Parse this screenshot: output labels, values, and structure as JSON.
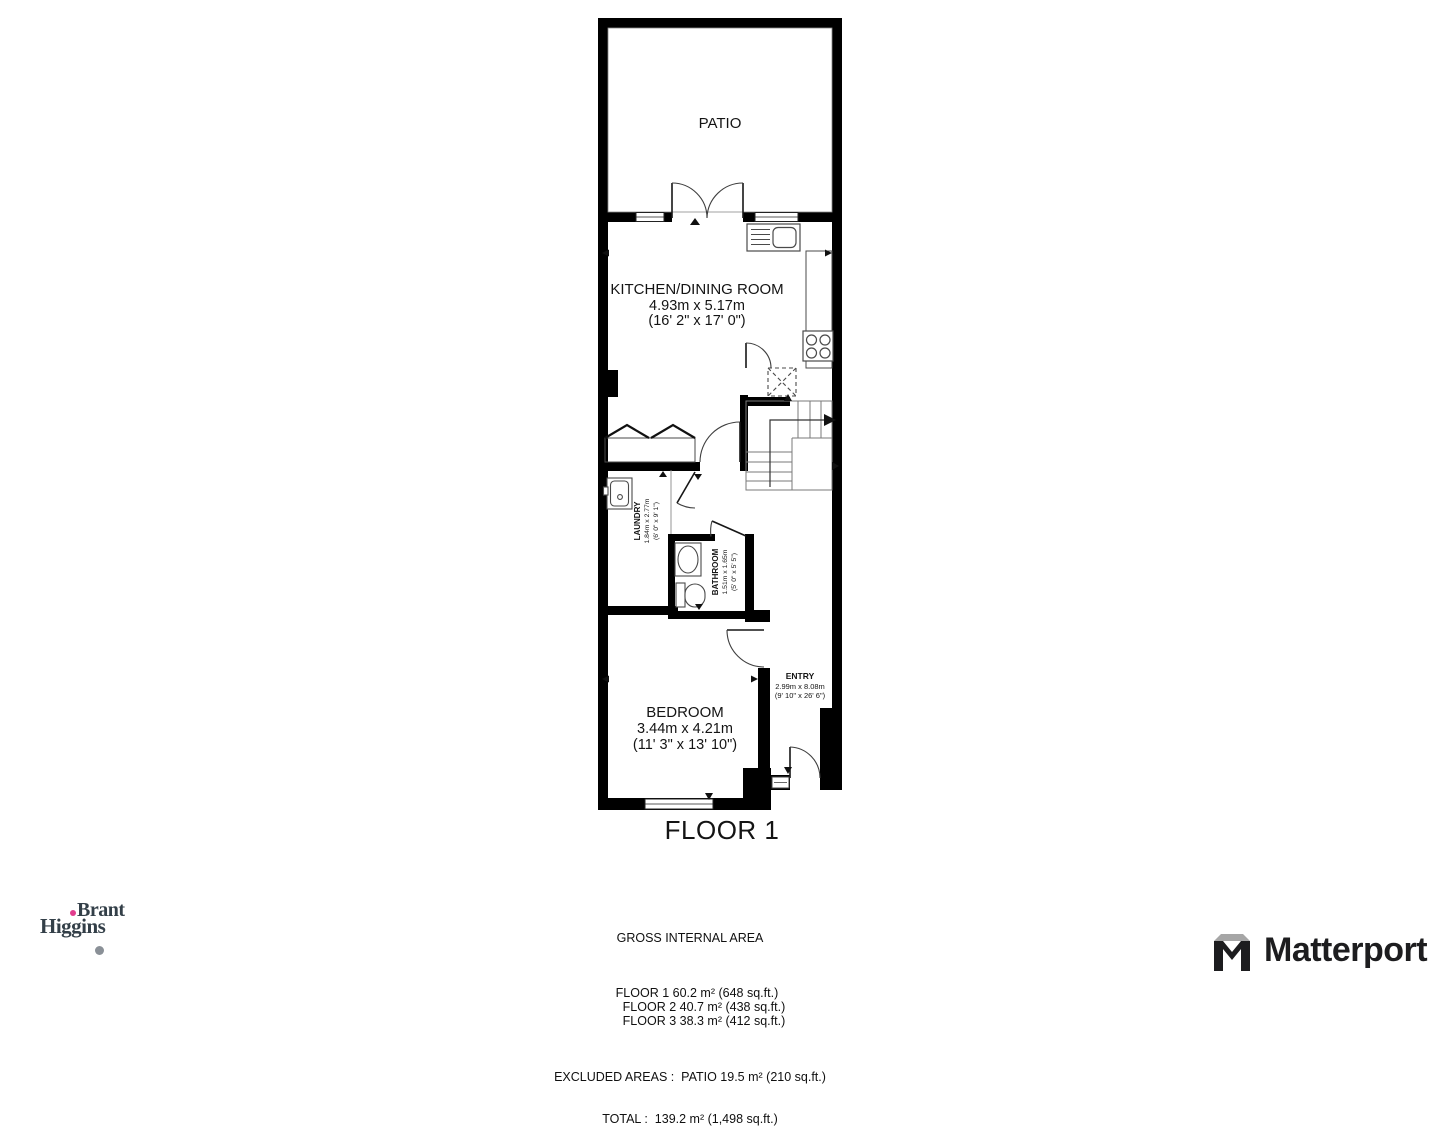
{
  "floor_label": "FLOOR 1",
  "rooms": {
    "patio": {
      "name": "PATIO"
    },
    "kitchen_dining": {
      "name": "KITCHEN/DINING ROOM",
      "size_metric": "4.93m x 5.17m",
      "size_imperial": "(16' 2\" x 17' 0\")"
    },
    "laundry": {
      "name": "LAUNDRY",
      "size_metric": "1.84m x 2.77m",
      "size_imperial": "(6' 0\" x 9' 1\")"
    },
    "bathroom": {
      "name": "BATHROOM",
      "size_metric": "1.51m x 1.65m",
      "size_imperial": "(5' 0\" x 5' 5\")"
    },
    "bedroom": {
      "name": "BEDROOM",
      "size_metric": "3.44m x 4.21m",
      "size_imperial": "(11' 3\" x 13' 10\")"
    },
    "entry": {
      "name": "ENTRY",
      "size_metric": "2.99m x 8.08m",
      "size_imperial": "(9' 10\" x 26' 6\")"
    }
  },
  "summary": {
    "heading": "GROSS INTERNAL AREA",
    "floors": [
      "FLOOR 1 60.2 m² (648 sq.ft.)",
      "FLOOR 2 40.7 m² (438 sq.ft.)",
      "FLOOR 3 38.3 m² (412 sq.ft.)"
    ],
    "excluded": "EXCLUDED AREAS :  PATIO 19.5 m² (210 sq.ft.)",
    "total": "TOTAL :  139.2 m² (1,498 sq.ft.)"
  },
  "branding": {
    "agency_name_line1": "Brant",
    "agency_name_line2": "Higgins",
    "provider_name": "Matterport"
  },
  "colors": {
    "wall": "#000000",
    "fixture_line": "#4a4a4a",
    "stair_line": "#7a7a7a",
    "text": "#141414",
    "agency_navy": "#333f48",
    "agency_pink": "#e23d8e",
    "provider_black": "#1d1d1f",
    "provider_gray": "#a6a6a6"
  }
}
